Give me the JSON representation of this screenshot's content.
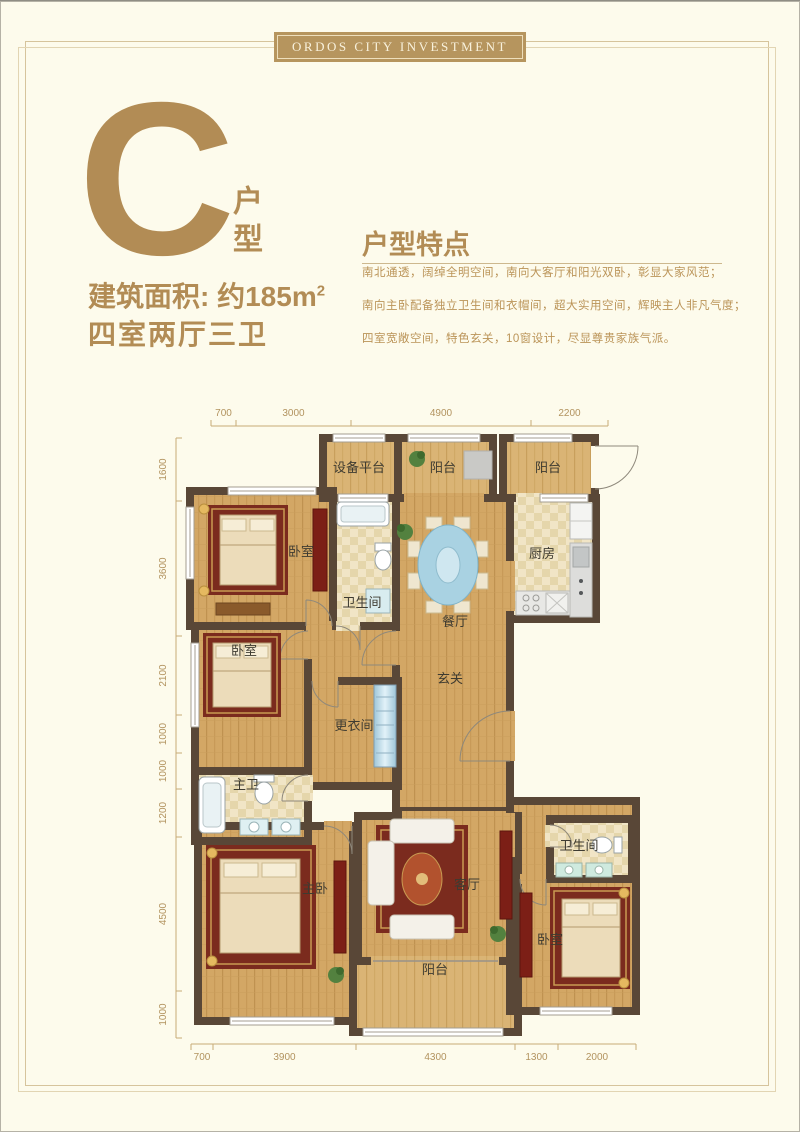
{
  "banner": {
    "text": "ORDOS CITY INVESTMENT"
  },
  "unit_badge": {
    "letter": "C",
    "type_label": "户型"
  },
  "summary": {
    "area": "建筑面积: 约185m",
    "area_exp": "2",
    "layout": "四室两厅三卫"
  },
  "features": {
    "title": "户型特点",
    "lines": [
      "南北通透，阔绰全明空间，南向大客厅和阳光双卧，彰显大家风范；",
      "南向主卧配备独立卫生间和衣帽间，超大实用空间，辉映主人非凡气度；",
      "四室宽敞空间，特色玄关，10窗设计，尽显尊贵家族气派。"
    ]
  },
  "colors": {
    "accent_gold": "#b28c55",
    "banner_bg": "#b6955e",
    "wall": "#594737",
    "wood_floor": "#d3a765",
    "tile_floor": "#f1e5c6",
    "dimension_text": "#b2935f"
  },
  "floorplan": {
    "room_labels": [
      {
        "name": "equipment-platform",
        "label": "设备平台",
        "x": 201,
        "y": 79
      },
      {
        "name": "balcony-north",
        "label": "阳台",
        "x": 285,
        "y": 79
      },
      {
        "name": "balcony-northeast",
        "label": "阳台",
        "x": 390,
        "y": 79
      },
      {
        "name": "bedroom-northwest",
        "label": "卧室",
        "x": 143,
        "y": 163
      },
      {
        "name": "bathroom-north",
        "label": "卫生间",
        "x": 204,
        "y": 214
      },
      {
        "name": "dining-room",
        "label": "餐厅",
        "x": 297,
        "y": 233
      },
      {
        "name": "kitchen",
        "label": "厨房",
        "x": 384,
        "y": 165
      },
      {
        "name": "bedroom-west",
        "label": "卧室",
        "x": 86,
        "y": 262
      },
      {
        "name": "dressing-room",
        "label": "更衣间",
        "x": 196,
        "y": 337
      },
      {
        "name": "foyer",
        "label": "玄关",
        "x": 292,
        "y": 290
      },
      {
        "name": "master-bathroom",
        "label": "主卫",
        "x": 88,
        "y": 396
      },
      {
        "name": "master-bedroom",
        "label": "主卧",
        "x": 157,
        "y": 500
      },
      {
        "name": "living-room",
        "label": "客厅",
        "x": 309,
        "y": 496
      },
      {
        "name": "bathroom-east",
        "label": "卫生间",
        "x": 421,
        "y": 457
      },
      {
        "name": "bedroom-southeast",
        "label": "卧室",
        "x": 392,
        "y": 551
      },
      {
        "name": "balcony-south",
        "label": "阳台",
        "x": 277,
        "y": 581
      }
    ],
    "dimensions": {
      "top": {
        "axis": "x",
        "line": 33,
        "tick": -6,
        "label": -10,
        "values": [
          700,
          3000,
          4900,
          2200
        ],
        "ticks": [
          53,
          78,
          193,
          373,
          450
        ]
      },
      "left": {
        "axis": "y",
        "line": 18,
        "tick": 6,
        "label": -10,
        "values": [
          1600,
          3600,
          2100,
          1000,
          1000,
          1200,
          4500,
          1000
        ],
        "ticks": [
          45,
          108,
          243,
          322,
          360,
          396,
          444,
          598,
          645
        ]
      },
      "bottom": {
        "axis": "x",
        "line": 651,
        "tick": 6,
        "label": 16,
        "values": [
          700,
          3900,
          4300,
          1300,
          2000
        ],
        "ticks": [
          33,
          55,
          198,
          357,
          400,
          478
        ]
      }
    }
  }
}
